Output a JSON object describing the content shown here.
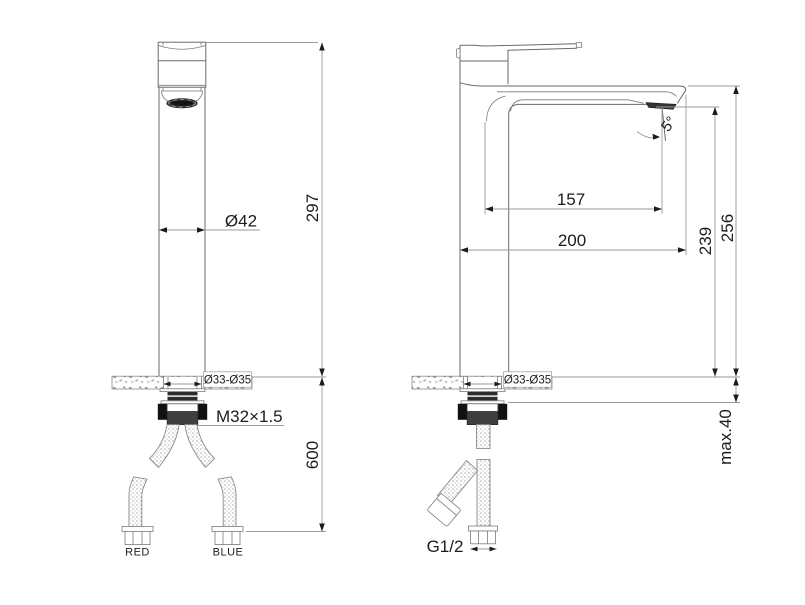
{
  "drawing": {
    "front_view": {
      "body_diameter": "Ø42",
      "height_above_deck": "297",
      "deck_hole_diameter": "Ø33-Ø35",
      "locknut_thread": "M32×1.5",
      "hose_length": "600",
      "hot_hose_label": "RED",
      "cold_hose_label": "BLUE"
    },
    "side_view": {
      "outlet_angle": "5°",
      "spout_reach": "157",
      "overall_depth": "200",
      "outlet_height": "239",
      "spout_top_height": "256",
      "deck_hole_diameter": "Ø33-Ø35",
      "max_deck_thickness": "max.40",
      "inlet_thread": "G1/2"
    }
  },
  "colors": {
    "background": "#ffffff",
    "geometry_line": "#6a6a6a",
    "dimension_line": "#9a9a9a",
    "text": "#1c1c1c",
    "dark_fill": "#2f2f2f"
  }
}
